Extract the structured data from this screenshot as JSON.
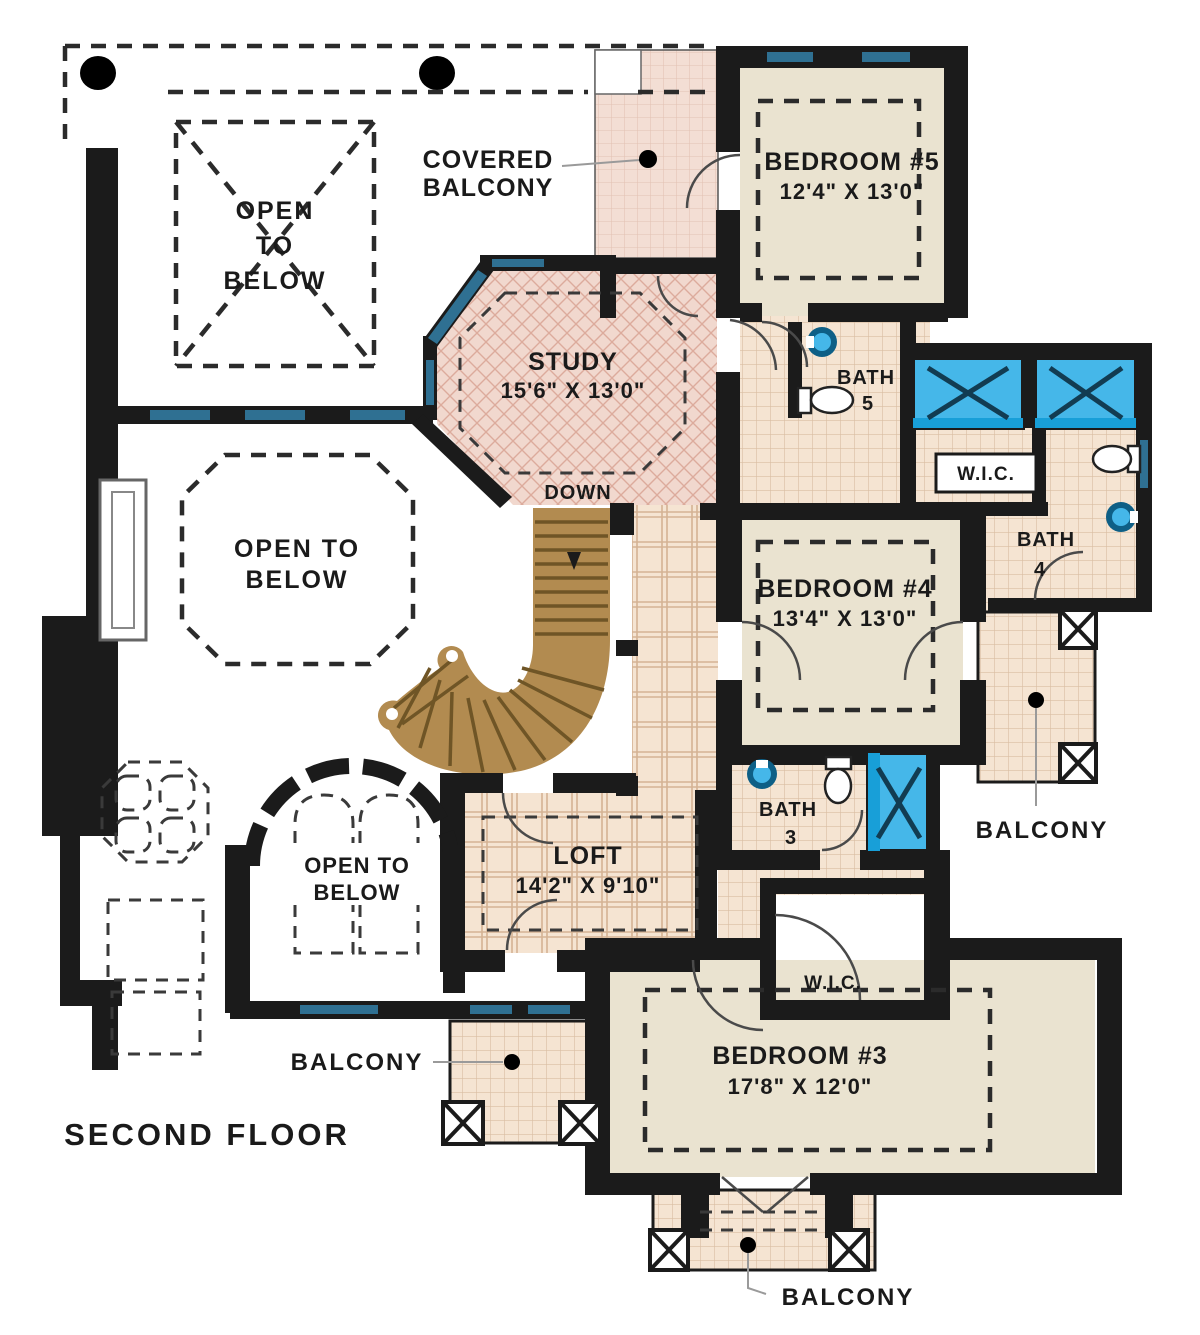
{
  "plan": {
    "title": "SECOND FLOOR",
    "stair_direction": "DOWN",
    "rooms": {
      "study": {
        "name": "STUDY",
        "dims": "15'6\" X 13'0\""
      },
      "bedroom5": {
        "name": "BEDROOM #5",
        "dims": "12'4\" X 13'0\""
      },
      "bedroom4": {
        "name": "BEDROOM #4",
        "dims": "13'4\" X 13'0\""
      },
      "bedroom3": {
        "name": "BEDROOM #3",
        "dims": "17'8\" X 12'0\""
      },
      "loft": {
        "name": "LOFT",
        "dims": "14'2\" X 9'10\""
      },
      "bath5": {
        "name": "BATH",
        "number": "5"
      },
      "bath4": {
        "name": "BATH",
        "number": "4"
      },
      "bath3": {
        "name": "BATH",
        "number": "3"
      },
      "wic_upper": {
        "name": "W.I.C."
      },
      "wic_lower": {
        "name": "W.I.C."
      }
    },
    "labels": {
      "covered_balcony": [
        "COVERED",
        "BALCONY"
      ],
      "open_to_below_top": [
        "OPEN",
        "TO",
        "BELOW"
      ],
      "open_to_below_mid": [
        "OPEN TO",
        "BELOW"
      ],
      "open_to_below_arch": [
        "OPEN TO",
        "BELOW"
      ],
      "balcony_right": "BALCONY",
      "balcony_lower_left": "BALCONY",
      "balcony_bottom": "BALCONY"
    },
    "colors": {
      "wall": "#1b1b1b",
      "room_fill": "#eae3d0",
      "tile_fill": "#f5e4d2",
      "tile_line": "#d9bda2",
      "pink_tile_fill": "#f3ded4",
      "pink_tile_line": "#e2c2b3",
      "study_fill": "#f1d8ce",
      "study_hatch": "#dcab9c",
      "stair_fill": "#b28b50",
      "stair_tread": "#6f5526",
      "shower_blue": "#45b7e9",
      "window_teal": "#2f7092",
      "text": "#1a1a1a"
    }
  }
}
